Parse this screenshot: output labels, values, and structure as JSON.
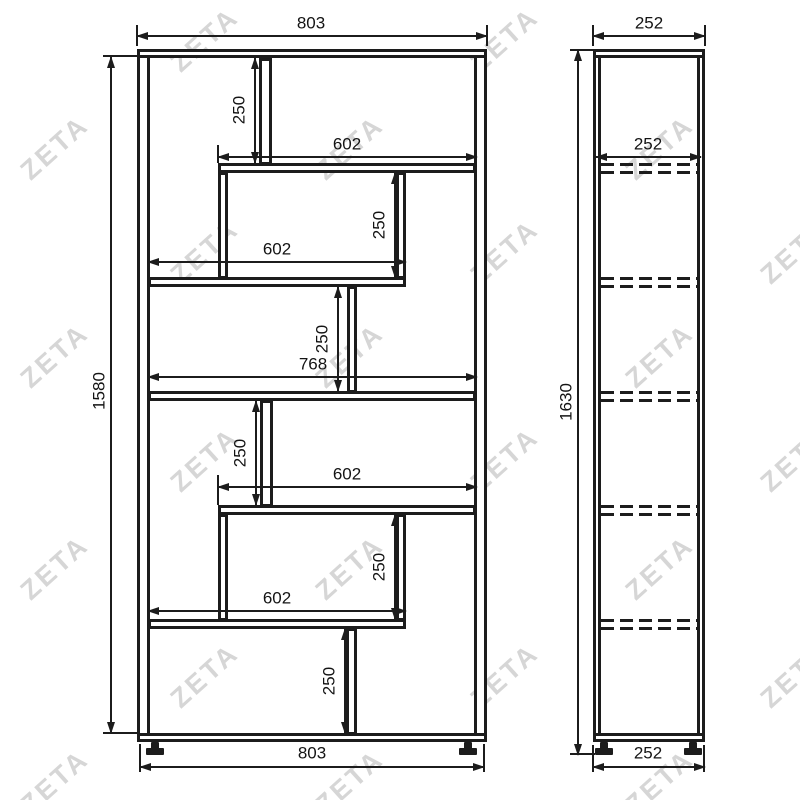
{
  "watermark": {
    "text": "ZETA"
  },
  "dimensions": {
    "front": {
      "overall_width_top": "803",
      "overall_width_bottom": "803",
      "overall_height": "1580",
      "inner_width": "768",
      "shelf1_width": "602",
      "shelf2_width": "602",
      "shelf4_width": "602",
      "shelf5_width": "602",
      "cell_height_1": "250",
      "cell_height_2": "250",
      "cell_height_3": "250",
      "cell_height_4": "250",
      "cell_height_5": "250",
      "cell_height_6": "250"
    },
    "side": {
      "depth_top": "252",
      "shelf_depth": "252",
      "depth_bottom": "252",
      "overall_height": "1630"
    }
  }
}
